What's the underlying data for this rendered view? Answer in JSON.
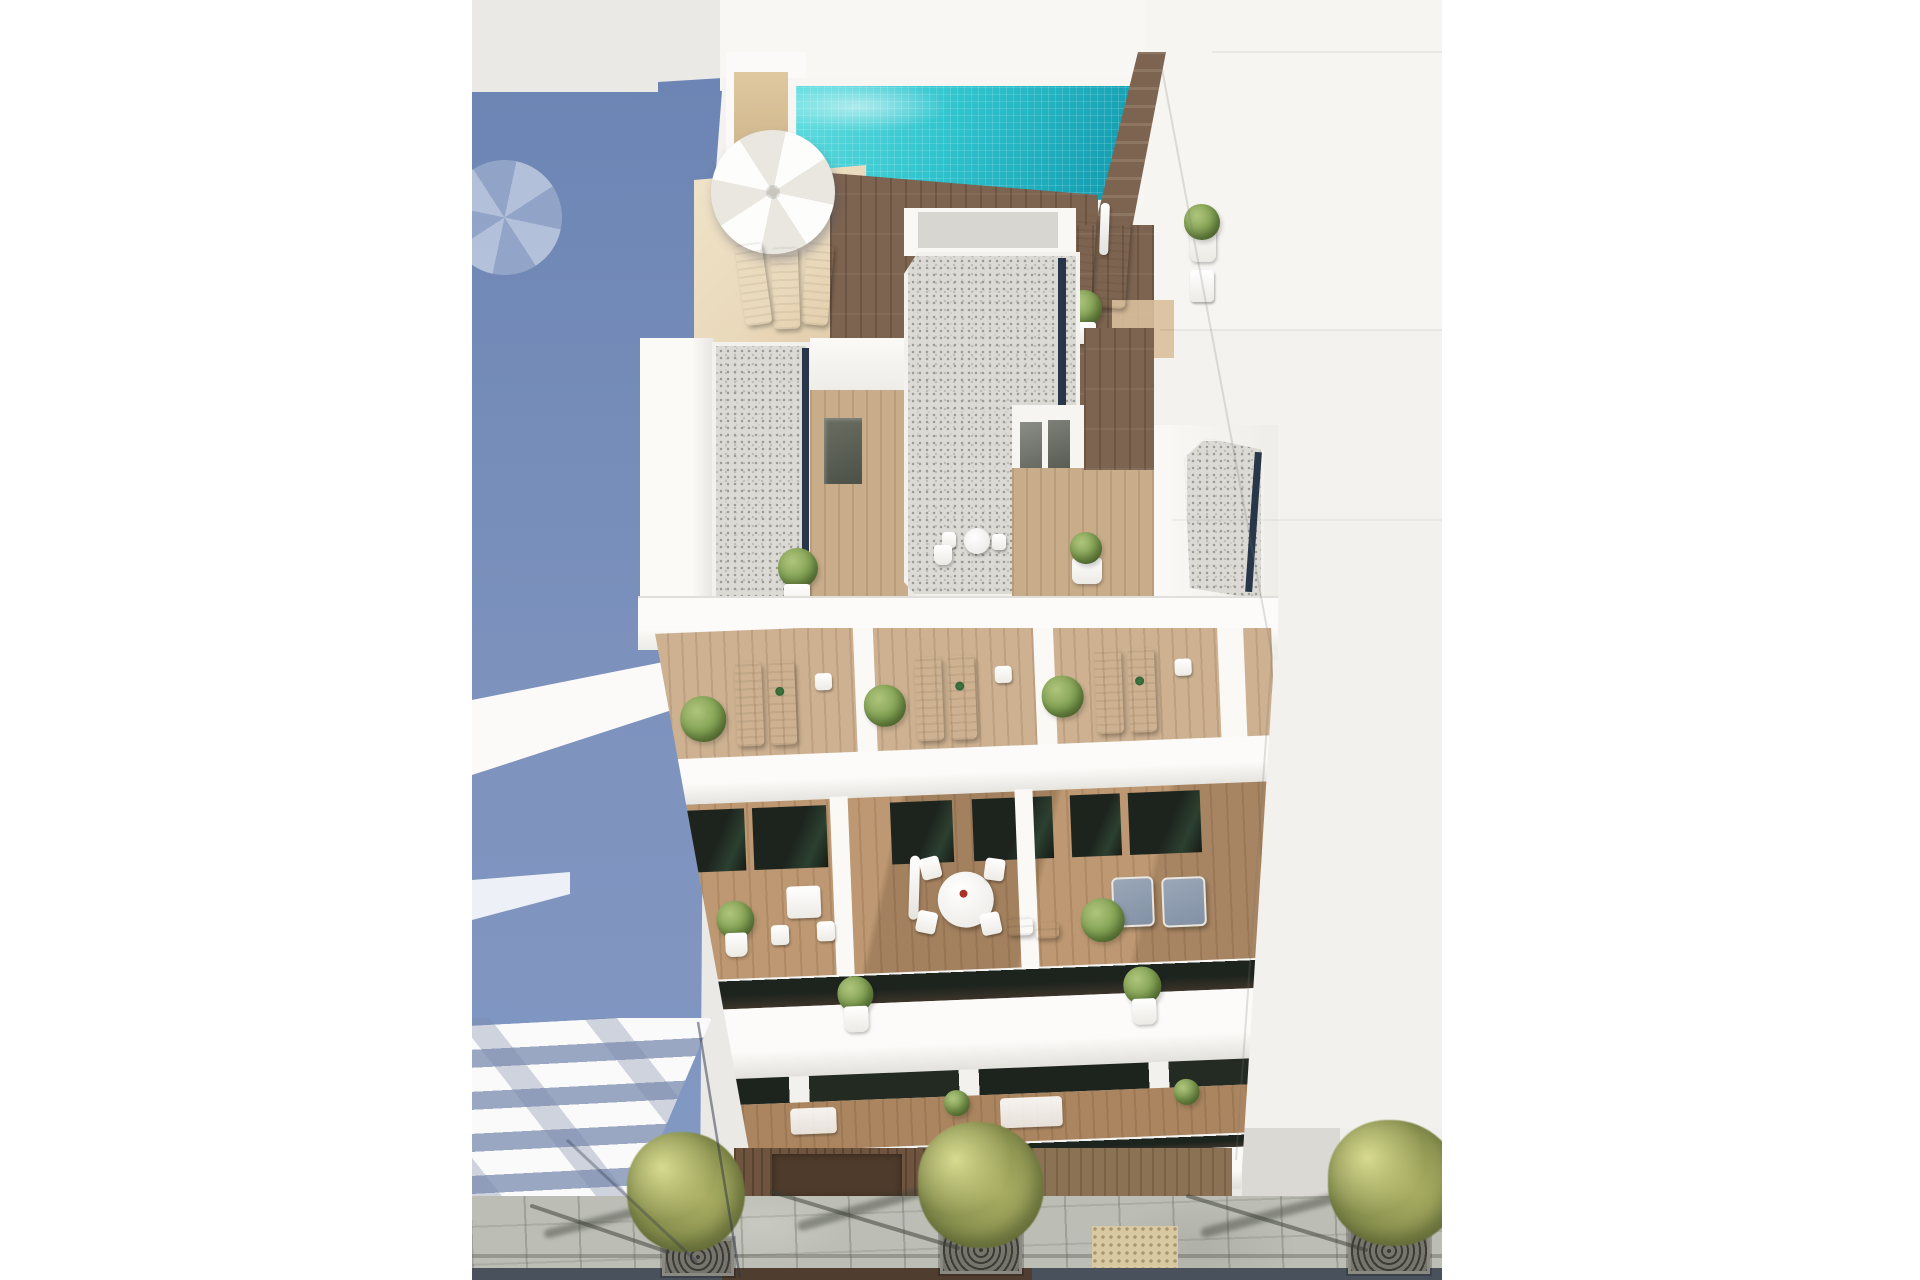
{
  "image": {
    "type": "architectural-3d-render",
    "view": "aerial top-down elevation",
    "subject": "modern white residential apartment building with rooftop pool, roof terraces, three balcony floors and a tree-lined sidewalk",
    "width_px": 1920,
    "height_px": 1280
  },
  "palette": {
    "page_bg": "#ffffff",
    "ground": "#eae9e5",
    "shadow_blue_1": "#6c85b4",
    "shadow_blue_2": "#8299c4",
    "slab_gap_blue": "#9aa7c3",
    "white_wall": "#faf9f6",
    "wall_tint": "#f0eeea",
    "pool_teal_light": "#63dee0",
    "pool_teal": "#2fc3cd",
    "pool_teal_deep": "#0f97ac",
    "pool_navy": "#1d4f6b",
    "beige_wall": "#dfc7a0",
    "beige_deck": "#ead9bb",
    "sand_step": "#c4a379",
    "wood_dark": "#7d6450",
    "wood_light": "#c9ad8a",
    "wood_balcony": "#bd9872",
    "wood_ground": "#6f553f",
    "wood_garage": "#4f3b2b",
    "gravel_base": "#dcdad5",
    "gravel_fleck_dark": "#9b9993",
    "gravel_fleck_mid": "#bdbbb5",
    "navy_edge": "#273648",
    "glass_dark": "#1d241e",
    "glass_green": "#2c4030",
    "slate_chair": "#8391a6",
    "plant_light": "#aec47c",
    "plant": "#7fa050",
    "plant_dark": "#58772f",
    "pot": "#eceae4",
    "furniture": "#edebe6",
    "paver": "#bcbdb4",
    "tactile": "#d9c9a2",
    "road": "#49525c",
    "road_brown": "#4f3e2f",
    "grate": "#3c3b36",
    "tree_olive": "#a9ad62",
    "tree_olive_dark": "#7c8547",
    "neighbor_1": "#f6f5f2",
    "neighbor_2": "#f4f2ee",
    "neighbor_3": "#f3f1ed",
    "neighbor_base": "#dbd9d4"
  },
  "scene": {
    "rooftop": {
      "pool": 1,
      "open_parasol": 1,
      "closed_parasols": 1,
      "sun_loungers": 5,
      "planters": 3,
      "gravel_roof_sections": 3
    },
    "terrace_level": {
      "lounger_pairs": 3,
      "side_tables": 3,
      "shrubs": 3,
      "doors": 4,
      "dining_sets": 2
    },
    "balcony_floors": {
      "count": 3,
      "round_table": 1,
      "square_table": 1,
      "closed_parasol": 1,
      "armchairs": 2,
      "potted_plants": 8
    },
    "street": {
      "trees": 3,
      "tree_grates": 3,
      "tactile_paving_patches": 1,
      "road_lanes_visible": 1
    },
    "surroundings": {
      "left_building_with_balcony_slabs": 1,
      "right_flat_roof_building": 1,
      "cast_building_shadow": 1,
      "umbrella_shadow": 1
    }
  }
}
